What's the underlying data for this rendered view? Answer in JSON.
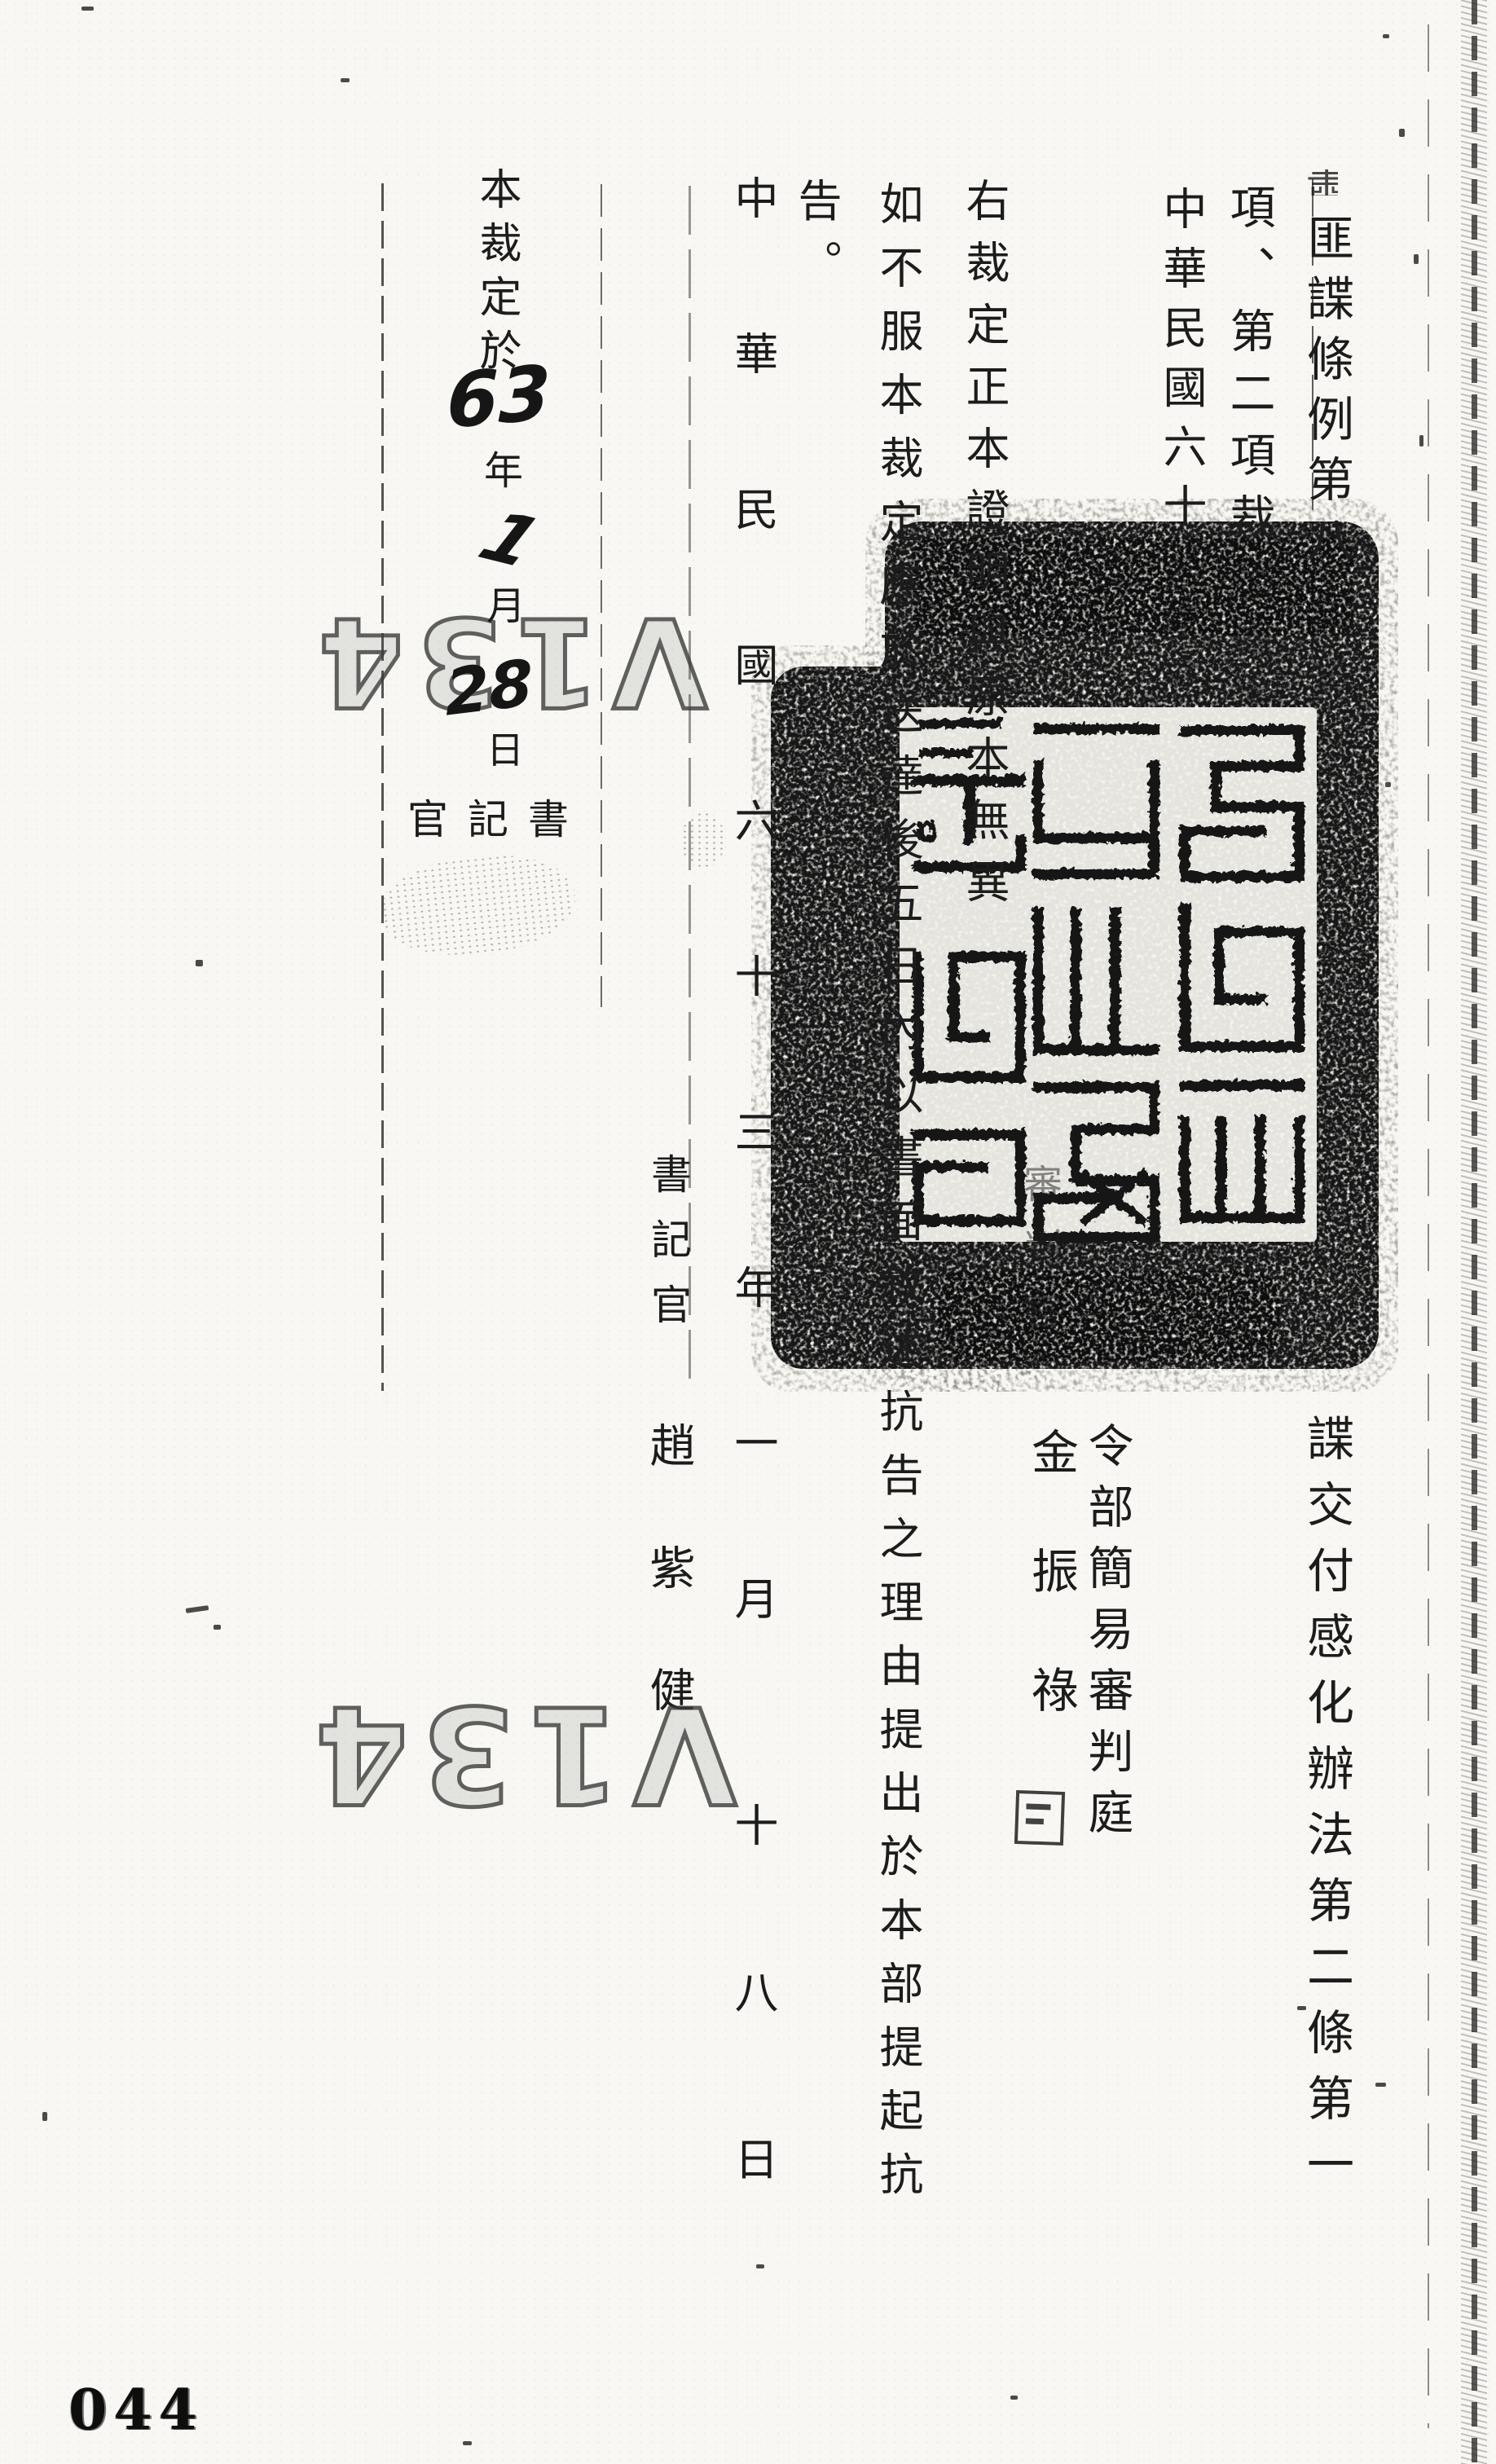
{
  "document": {
    "page_number": "044",
    "ruling_citation": {
      "col1_pre": "肅",
      "col1_top": "匪諜條例第八",
      "col1_hidden": "條第一",
      "col1_bottom": "諜交付感化辦法第二條第一",
      "col2_top": "項、第二項裁",
      "col2_hidden": "定如主文。",
      "col3_top": "中華民國六十",
      "col3_hidden": "三年元月卅一日"
    },
    "original_court": {
      "court_line": "令部簡易審判庭",
      "judge_title": "審判官",
      "judge_name": "金振祿"
    },
    "certification": {
      "line1": "右裁定正本證明與原本無異",
      "line2": "如不服本裁定應於送達後五日內以書面敘述抗告之理由提出於本部提起抗",
      "line2_wrap": "告。",
      "date_main": "中華民國六十三年一月",
      "date_tail": "十八日",
      "clerk_title": "書記官",
      "clerk_name": "趙紫健"
    },
    "service_note": {
      "prefix": "本裁定於",
      "year_label": "年",
      "month_label": "月",
      "day_label": "日",
      "clerk_row": "官記書"
    },
    "handwriting": {
      "year": "63",
      "month": "1",
      "day": "28"
    },
    "stamps": {
      "file_code": "V134"
    },
    "colors": {
      "ink": "#1c1c1c",
      "paper": "#f8f7f3",
      "stamp_ink": "#171717"
    }
  }
}
